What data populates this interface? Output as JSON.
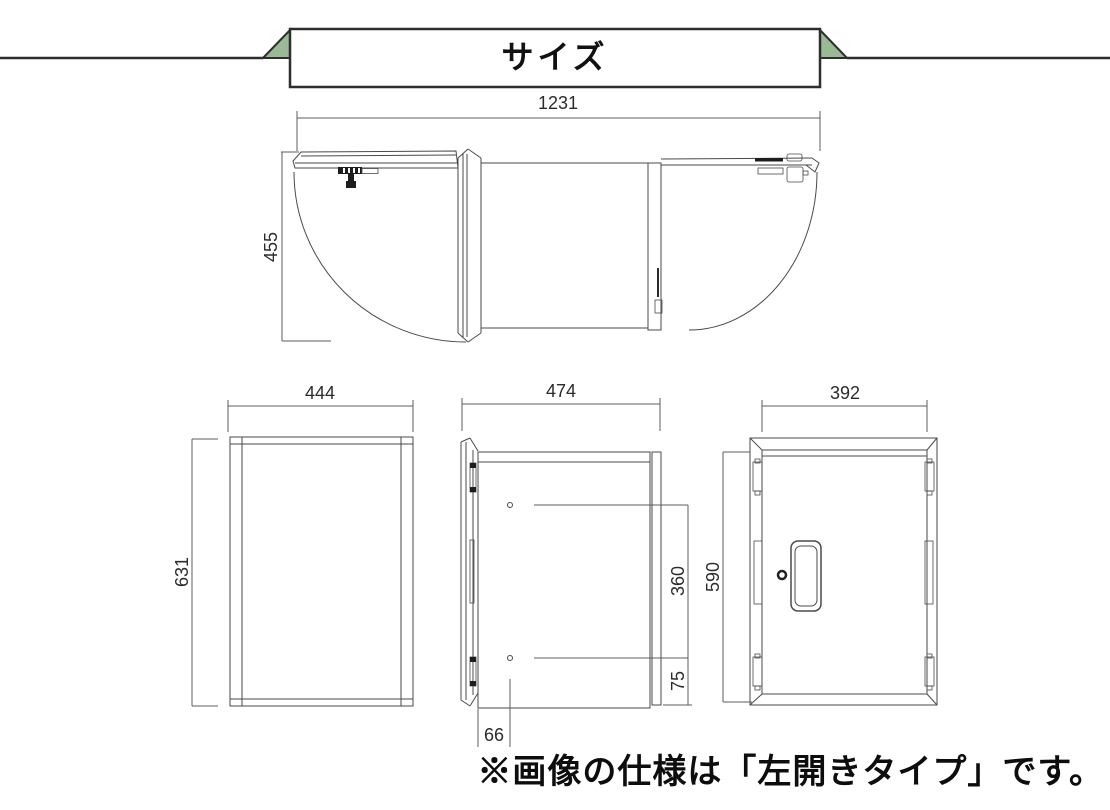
{
  "banner": {
    "title": "サイズ"
  },
  "top_view": {
    "width_mm": "1231",
    "depth_mm": "455"
  },
  "front_view": {
    "width_mm": "444",
    "height_mm": "631"
  },
  "side_view": {
    "depth_mm": "474",
    "hole_pitch_mm": "360",
    "hole_bottom_mm": "75",
    "hole_side_mm": "66"
  },
  "rear_view": {
    "width_mm": "392",
    "height_mm": "590"
  },
  "note": {
    "text": "※画像の仕様は「左開きタイプ」です。"
  },
  "colors": {
    "ribbon_green": "#9bb996",
    "line": "#4a4a4a",
    "banner_border": "#2e2e2e"
  }
}
